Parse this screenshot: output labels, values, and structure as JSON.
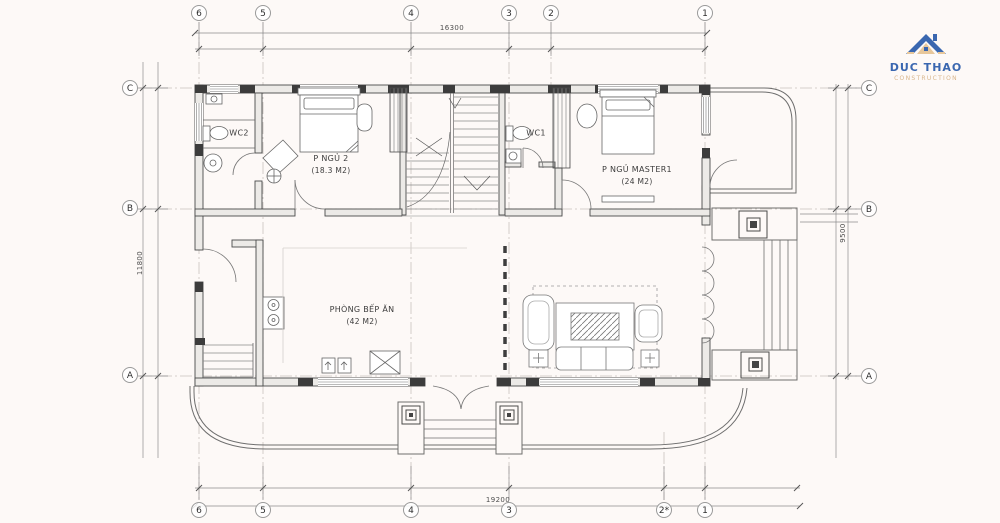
{
  "logo": {
    "title": "DUC THAO",
    "subtitle": "CONSTRUCTION"
  },
  "grid": {
    "top": [
      "6",
      "5",
      "4",
      "3",
      "2",
      "1"
    ],
    "bottom": [
      "6",
      "5",
      "4",
      "3",
      "2*",
      "1"
    ],
    "left": [
      "C",
      "B",
      "A"
    ],
    "right": [
      "C",
      "B",
      "A"
    ]
  },
  "dimensions": {
    "top": "16300",
    "bottom": "19200",
    "left": "11800",
    "right": "9500"
  },
  "rooms": {
    "wc2": {
      "name": "WC2"
    },
    "wc1": {
      "name": "WC1"
    },
    "bedroom2": {
      "name": "P NGỦ 2",
      "area": "(18.3 M2)"
    },
    "master": {
      "name": "P NGỦ MASTER1",
      "area": "(24 M2)"
    },
    "kitchen": {
      "name": "PHÒNG BẾP ĂN",
      "area": "(42 M2)"
    }
  },
  "colors": {
    "background": "#fdf9f7",
    "line": "#6e6e6e",
    "wall": "#4a4a4a",
    "logo_blue": "#3a67b0",
    "logo_tan": "#d9b68c"
  }
}
